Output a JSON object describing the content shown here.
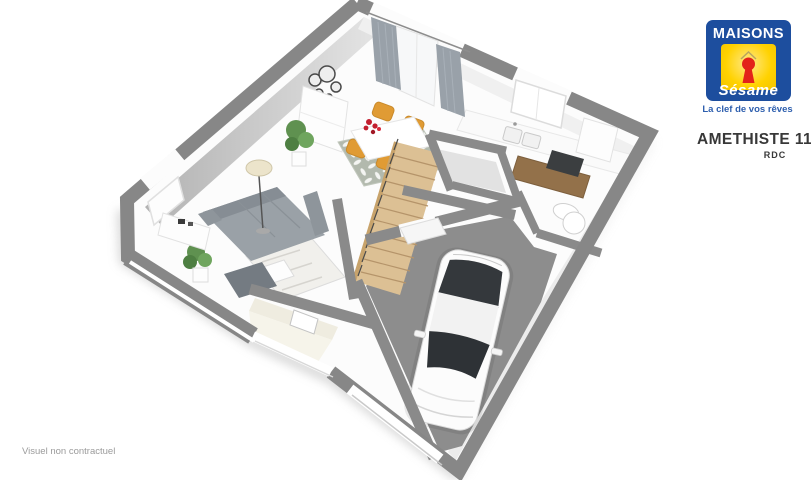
{
  "branding": {
    "name": "MAISONS",
    "script_name": "Sésame",
    "tagline": "La clef de vos rêves",
    "colors": {
      "blue": "#1d4e9e",
      "yellow": "#ffd200",
      "red": "#e32219"
    }
  },
  "plan": {
    "title": "AMETHISTE 110 GI",
    "floor": "RDC",
    "disclaimer": "Visuel non contractuel",
    "colors": {
      "wall_top": "#8a8a8a",
      "wall_face": "#c9c9c9",
      "floor": "#fcfcfc",
      "garage_floor": "#8d8d8d",
      "stairs_wood": "#dcc094",
      "dining_chair": "#e09b34",
      "sofa": "#9aa1a7",
      "rug_leaf": "#b2b9ad"
    },
    "elements": [
      "sofa",
      "ottoman",
      "coffee-table-rug",
      "floor-lamp",
      "tv-console",
      "wall-mirror-decor",
      "sideboard",
      "potted-plants",
      "dining-table",
      "dining-chairs",
      "flower-bouquet",
      "leaf-rug",
      "staircase",
      "kitchen-counter",
      "kitchen-sink",
      "cooktop",
      "wood-counter",
      "fridge-cabinet",
      "wc-toilet",
      "garage",
      "car",
      "curtains",
      "windows",
      "front-door",
      "entrance-porch"
    ]
  }
}
